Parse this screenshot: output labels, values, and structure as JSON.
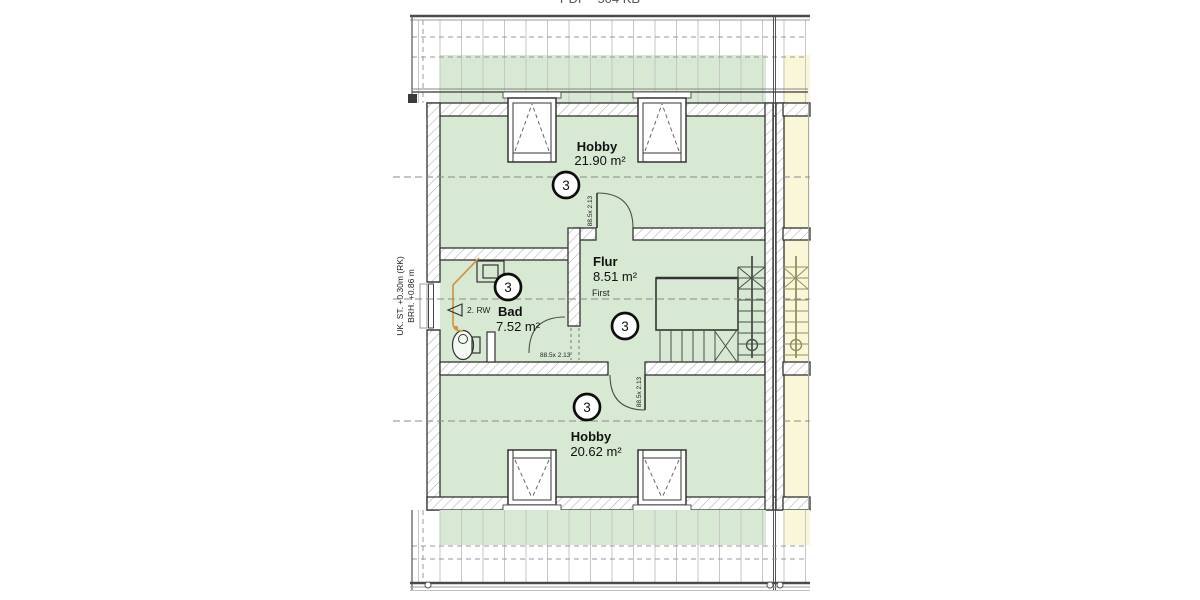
{
  "header": {
    "file_label": "PDF - 504 KB"
  },
  "plan": {
    "rooms": [
      {
        "name": "Hobby",
        "area": "21.90 m²",
        "zone": "3"
      },
      {
        "name": "Flur",
        "area": "8.51 m²",
        "zone": "3"
      },
      {
        "name": "Bad",
        "area": "7.52 m²",
        "zone": "3"
      },
      {
        "name": "Hobby",
        "area": "20.62 m²",
        "zone": "3"
      }
    ],
    "annotations": {
      "left_note_line1": "UK. ST. +0.30m (RK)",
      "left_note_line2": "BRH. +0.86 m",
      "ridge_label": "First",
      "escape_route": "2. RW",
      "door_size": "88.5x 2.13"
    },
    "colors": {
      "unit_fill": "#d7e8d3",
      "neighbor_fill": "#faf7d8",
      "wall_line": "#333333",
      "pipe": "#cf9744",
      "dashed_line": "#8a8a8a"
    }
  }
}
